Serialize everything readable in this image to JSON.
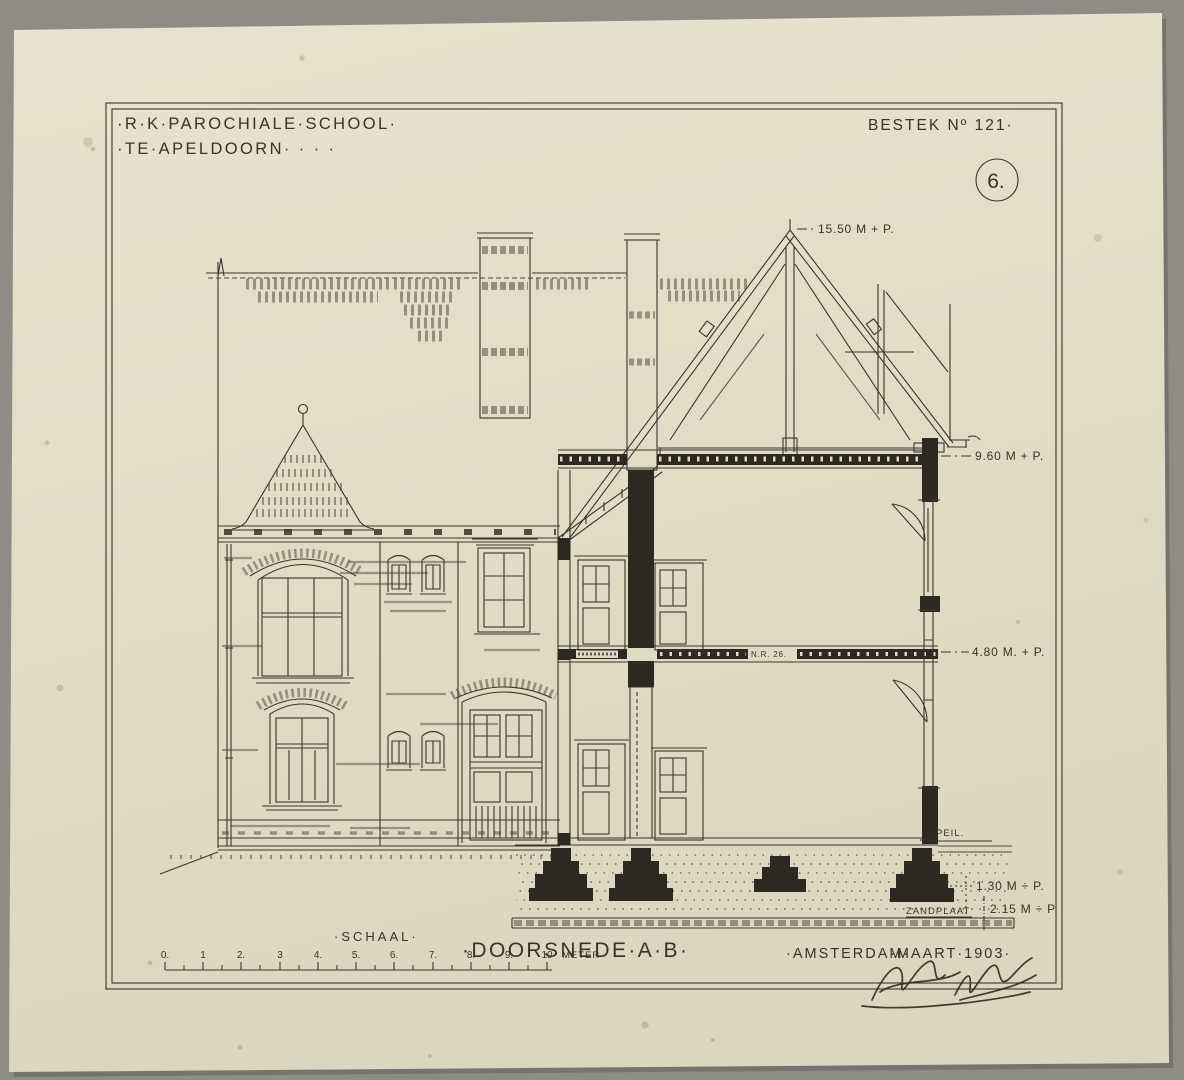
{
  "header": {
    "title_line1": "·R·K·PAROCHIALE·SCHOOL·",
    "title_line2": "·TE·APELDOORN·  ·   ·    ·",
    "bestek": "BESTEK Nº 121·",
    "sheet_number": "6."
  },
  "annotations": {
    "ridge_height": "15.50 M + P.",
    "attic_level": "9.60 M + P.",
    "floor_level": "4.80 M. + P.",
    "peil": "PEIL.",
    "foundation_depth": "1.30 M ÷ P.",
    "zandplaat": "ZANDPLAAT",
    "zandplaat_depth": "2.15 M ÷ P.",
    "beam_mark": "N.R. 26."
  },
  "footer": {
    "schaal_label": "·SCHAAL·",
    "drawing_title": "·DOORSNEDE·A·B·",
    "city": "·AMSTERDAM·",
    "date": "·MAART·1903·",
    "meter_label": "METER"
  },
  "scale_bar": {
    "ticks": [
      "0.",
      "1",
      "2.",
      "3",
      "4.",
      "5.",
      "6.",
      "7.",
      "8.",
      "9.",
      "10"
    ]
  },
  "colors": {
    "backdrop": "#8f8c86",
    "paper": "#e1ddc7",
    "ink": "#3a342a"
  }
}
